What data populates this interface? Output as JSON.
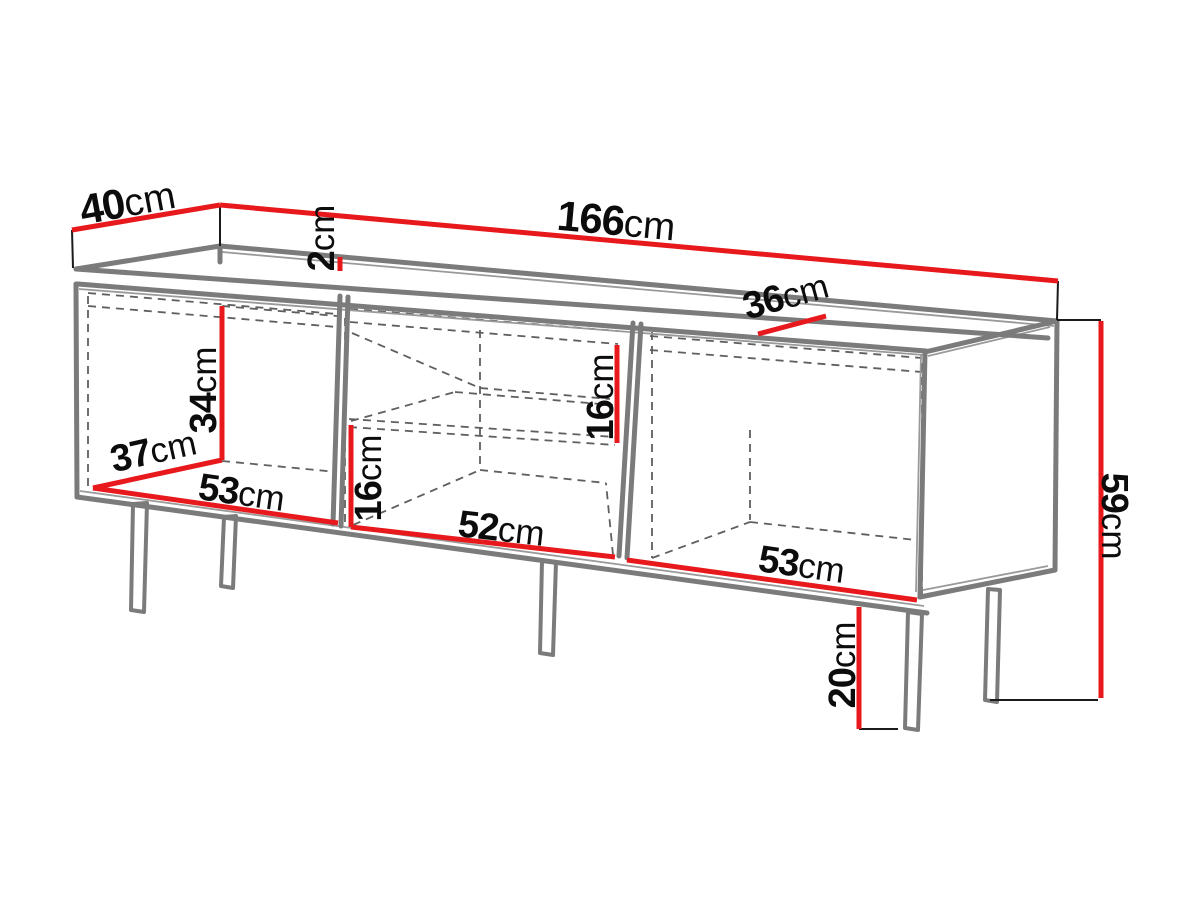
{
  "diagram": {
    "title": "TV stand dimension diagram",
    "unit": "cm"
  },
  "dims": {
    "depth": {
      "value": "40",
      "unit": "cm",
      "meaning": "overall depth"
    },
    "width": {
      "value": "166",
      "unit": "cm",
      "meaning": "overall width"
    },
    "top_thickness": {
      "value": "2",
      "unit": "cm",
      "meaning": "top panel thickness"
    },
    "interior_depth": {
      "value": "36",
      "unit": "cm",
      "meaning": "interior depth"
    },
    "left_height": {
      "value": "34",
      "unit": "cm",
      "meaning": "left compartment interior height"
    },
    "left_depth": {
      "value": "37",
      "unit": "cm",
      "meaning": "left compartment interior depth"
    },
    "left_width": {
      "value": "53",
      "unit": "cm",
      "meaning": "left compartment interior width"
    },
    "middle_lower_height": {
      "value": "16",
      "unit": "cm",
      "meaning": "middle compartment below shelf"
    },
    "middle_width": {
      "value": "52",
      "unit": "cm",
      "meaning": "middle compartment interior width"
    },
    "middle_upper_height": {
      "value": "16",
      "unit": "cm",
      "meaning": "middle compartment above shelf"
    },
    "right_width": {
      "value": "53",
      "unit": "cm",
      "meaning": "right compartment interior width"
    },
    "leg_height": {
      "value": "20",
      "unit": "cm",
      "meaning": "leg height"
    },
    "total_height": {
      "value": "59",
      "unit": "cm",
      "meaning": "overall height"
    }
  },
  "colors": {
    "dimension_red": "#e8191d",
    "outline_grey": "#7b7b7b",
    "outline_thin_grey": "#9a9a9a",
    "hidden_edge_grey": "#5f5f5f",
    "extension_black": "#1a1a1a",
    "label_black": "#0c0c0c",
    "background": "#ffffff"
  }
}
